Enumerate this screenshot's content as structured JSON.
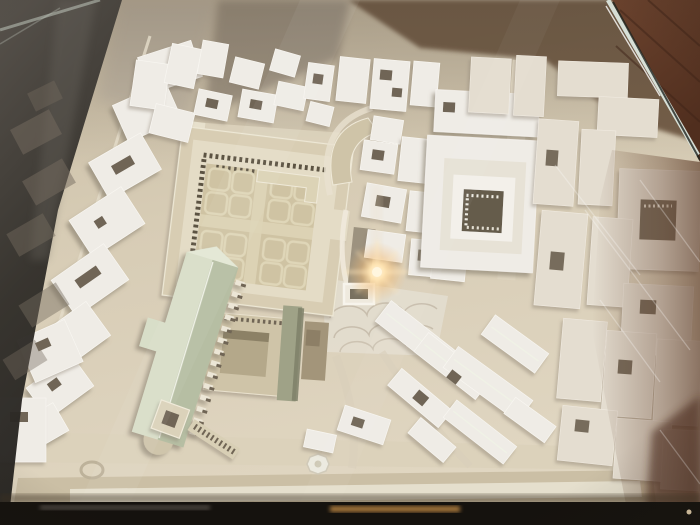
{
  "scene": {
    "type": "photograph",
    "description": "Overhead photograph of a white plaster architectural scale model of a historic city quarter displayed under tinted display-case glass; a camera-flash glare glows near the centre, a red-brown tiled museum floor shows past the glass edge at the top right, and the dark case frame crosses the bottom.",
    "setting": "museum display case, aerial oblique view",
    "objects": [
      {
        "name": "city-model",
        "label": "White plaster urban scale model"
      },
      {
        "name": "forum-courtyard",
        "label": "Large colonnaded forum courtyard with coffered garden parterre"
      },
      {
        "name": "peristyle-courtyard",
        "label": "Smaller colonnaded peristyle courtyard"
      },
      {
        "name": "basilica-roof",
        "label": "Long gabled basilica roof in pale sage green"
      },
      {
        "name": "bell-tower",
        "label": "Bell tower and arcaded loggia beside the basilica"
      },
      {
        "name": "cloister-courtyard",
        "label": "Aged cloister courtyard with colonnade"
      },
      {
        "name": "fan-paved-piazza",
        "label": "Piazza with fan-patterned stone paving"
      },
      {
        "name": "city-blocks",
        "label": "Surrounding city blocks with rectangular light wells"
      },
      {
        "name": "flash-reflection",
        "label": "Golden camera-flash glare on the glass"
      },
      {
        "name": "display-case-glass",
        "label": "Tinted display-case glass with bright bevelled edge"
      },
      {
        "name": "tiled-floor",
        "label": "Red-brown tiled museum floor beyond the glass"
      },
      {
        "name": "case-frame",
        "label": "Dark case frame band along the bottom edge"
      }
    ]
  },
  "palette": {
    "base-beige": "#d5c9b1",
    "white-top": "#efece6",
    "white-edge": "#f8f6f1",
    "white-muted": "#e4ddd0",
    "court-hole": "#6f6556",
    "forum-ring": "#d8cdb3",
    "forum-wall": "#e4dcc6",
    "forum-floor": "#cfc3a3",
    "floor-path": "#ddd4b6",
    "floor-motif": "#dfd6b8",
    "colonnade": "#5b5342",
    "aged-beige": "#cfc4a8",
    "roof-light": "#d8dec8",
    "roof-dark": "#b6bea3",
    "ridge": "#f0f2e6",
    "palazzo-green": "#9fa287",
    "glass-dark": "#33302b",
    "ghost": "#756c5f",
    "wall-beige": "#c2b8a6",
    "upper-gray": "#958a7a",
    "upper-brown": "#6b523c",
    "floor-brown": "#673f2c",
    "glass-edge": "#dde7df",
    "frame-black": "#15120e",
    "streak-amber": "#b5813f",
    "flare-core": "#fff7e3",
    "flare-warm": "#f4c07c"
  },
  "flare": {
    "x": 377,
    "y": 272
  }
}
